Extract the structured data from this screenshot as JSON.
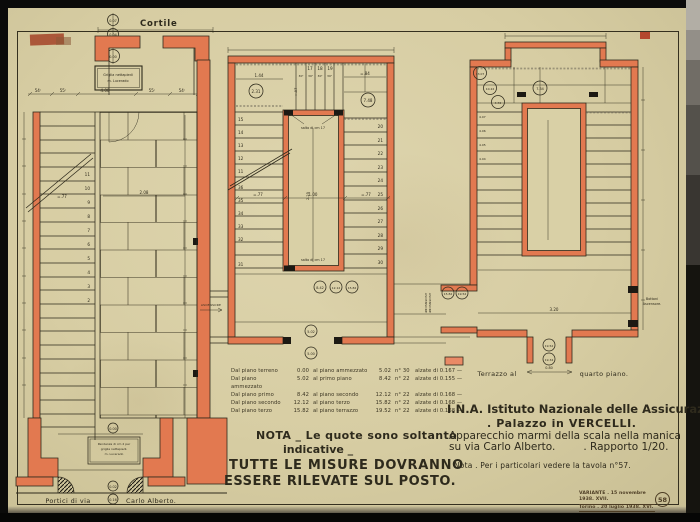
{
  "palette": {
    "paper": "#d9d0a6",
    "wall_red": "#e27950",
    "ink": "#2e2a1c",
    "scan_bg": "#0b0b0a"
  },
  "drawing": {
    "left_plan": {
      "top_label": "Cortile",
      "elevation_marks": [
        "0.07",
        "0.04",
        "0.00"
      ],
      "grille_box": [
        "Griglia nettapiedi",
        "m. Lucerado"
      ],
      "top_dims": [
        "54ᶜ",
        "55ᶜ",
        "4.00",
        "55ᶜ",
        "54ᶜ",
        "1ᶜ"
      ],
      "stair_numbers": [
        "11",
        "10",
        "9",
        "8",
        "7",
        "6",
        "5",
        "4",
        "3",
        "2"
      ],
      "stair_width_dim": "=.77",
      "hall_dim": "2.08",
      "bottom_box": [
        "Pendenza di cm 2 per",
        "griglia nettapiedi.",
        "m. Lucerado"
      ],
      "bottom_marks": [
        "0.00",
        "0.02"
      ],
      "bottom_label_left": "Portici di via",
      "bottom_label_mark": "0.16",
      "bottom_label_right": "Carlo Alberto."
    },
    "middle_plan": {
      "left_stair_numbers": [
        "15",
        "14",
        "13",
        "12",
        "11",
        "36",
        "35",
        "34",
        "33",
        "32",
        "31"
      ],
      "top_stair_numbers": [
        "17",
        "18",
        "19"
      ],
      "top_tread_dim": "30ᶜ",
      "right_stair_numbers": [
        "20",
        "21",
        "22",
        "23",
        "24",
        "25",
        "26",
        "27",
        "28",
        "29",
        "30"
      ],
      "elev_upper_left": "2.31",
      "elev_upper_right": "7.48",
      "elev_mid": [
        "8.42",
        "12.12",
        "15.82"
      ],
      "elev_landing": "5.02",
      "elev_below": "5.00",
      "core_note": "salto di cm 17",
      "dim_top_left": "1.44",
      "dim_top_right": "=.84",
      "dim_flight_left": "=.77",
      "dim_well": "1.00",
      "dim_flight_right": "=.77",
      "dim_core_height": "2.25",
      "dim_core_top": "=.97",
      "ascensore_left": "ASCENSORE",
      "ascensore_right": "ASCENSORE"
    },
    "right_plan": {
      "elevation_marks": [
        "13.07",
        "10.22",
        "4.72",
        "7.34"
      ],
      "left_flight_marks": [
        "4.07",
        "4.06",
        "4.05",
        "4.04"
      ],
      "landing_marks": [
        "19.52",
        "19.34"
      ],
      "side_marks": [
        "15.82",
        "19.52"
      ],
      "ascensore": "ASCENSORE",
      "buttons_label": [
        "Bottoni",
        "Ascensore."
      ],
      "dim_well": "3.20",
      "dim_door": "0.80",
      "caption_left": "Terrazzo al",
      "caption_right": "quarto piano."
    }
  },
  "riser_table": {
    "rows": [
      {
        "from": "Dal piano terreno",
        "from_q": "0.00",
        "to": "al piano ammezzato",
        "to_q": "5.02",
        "count": "n° 30",
        "riser": "alzate di 0.167 —"
      },
      {
        "from": "Dal piano ammezzato",
        "from_q": "5.02",
        "to": "al primo piano",
        "to_q": "8.42",
        "count": "n° 22",
        "riser": "alzate di 0.155 —"
      },
      {
        "from": "Dal piano primo",
        "from_q": "8.42",
        "to": "al piano secondo",
        "to_q": "12.12",
        "count": "n° 22",
        "riser": "alzate di 0.168 —"
      },
      {
        "from": "Dal piano secondo",
        "from_q": "12.12",
        "to": "al piano terzo",
        "to_q": "15.82",
        "count": "n° 22",
        "riser": "alzate di 0.168 —"
      },
      {
        "from": "Dal piano terzo",
        "from_q": "15.82",
        "to": "al piano terrazzo",
        "to_q": "19.52",
        "count": "n° 22",
        "riser": "alzate di 0.168 —"
      }
    ]
  },
  "nota_block": {
    "line1": "NOTA _ Le quote sono soltanto",
    "line2": "indicative _",
    "line3": "TUTTE LE MISURE DOVRANNO",
    "line4": "ESSERE RILEVATE SUL POSTO."
  },
  "title_block": {
    "line1": "I.N.A. Istituto Nazionale delle Assicurazioni",
    "line2": ". Palazzo in VERCELLI.",
    "line3": "Apparecchio marmi della scala nella manica",
    "line4a": "su via Carlo Alberto.",
    "line4b": ". Rapporto 1/20.",
    "nota": "Nota . Per i particolari vedere la tavola n°57."
  },
  "stamp": {
    "line1": "VARIANTE . 15 novembre 1938. XVII.",
    "line2": "Torino . 20 luglio 1938. XVI.",
    "number": "58"
  }
}
